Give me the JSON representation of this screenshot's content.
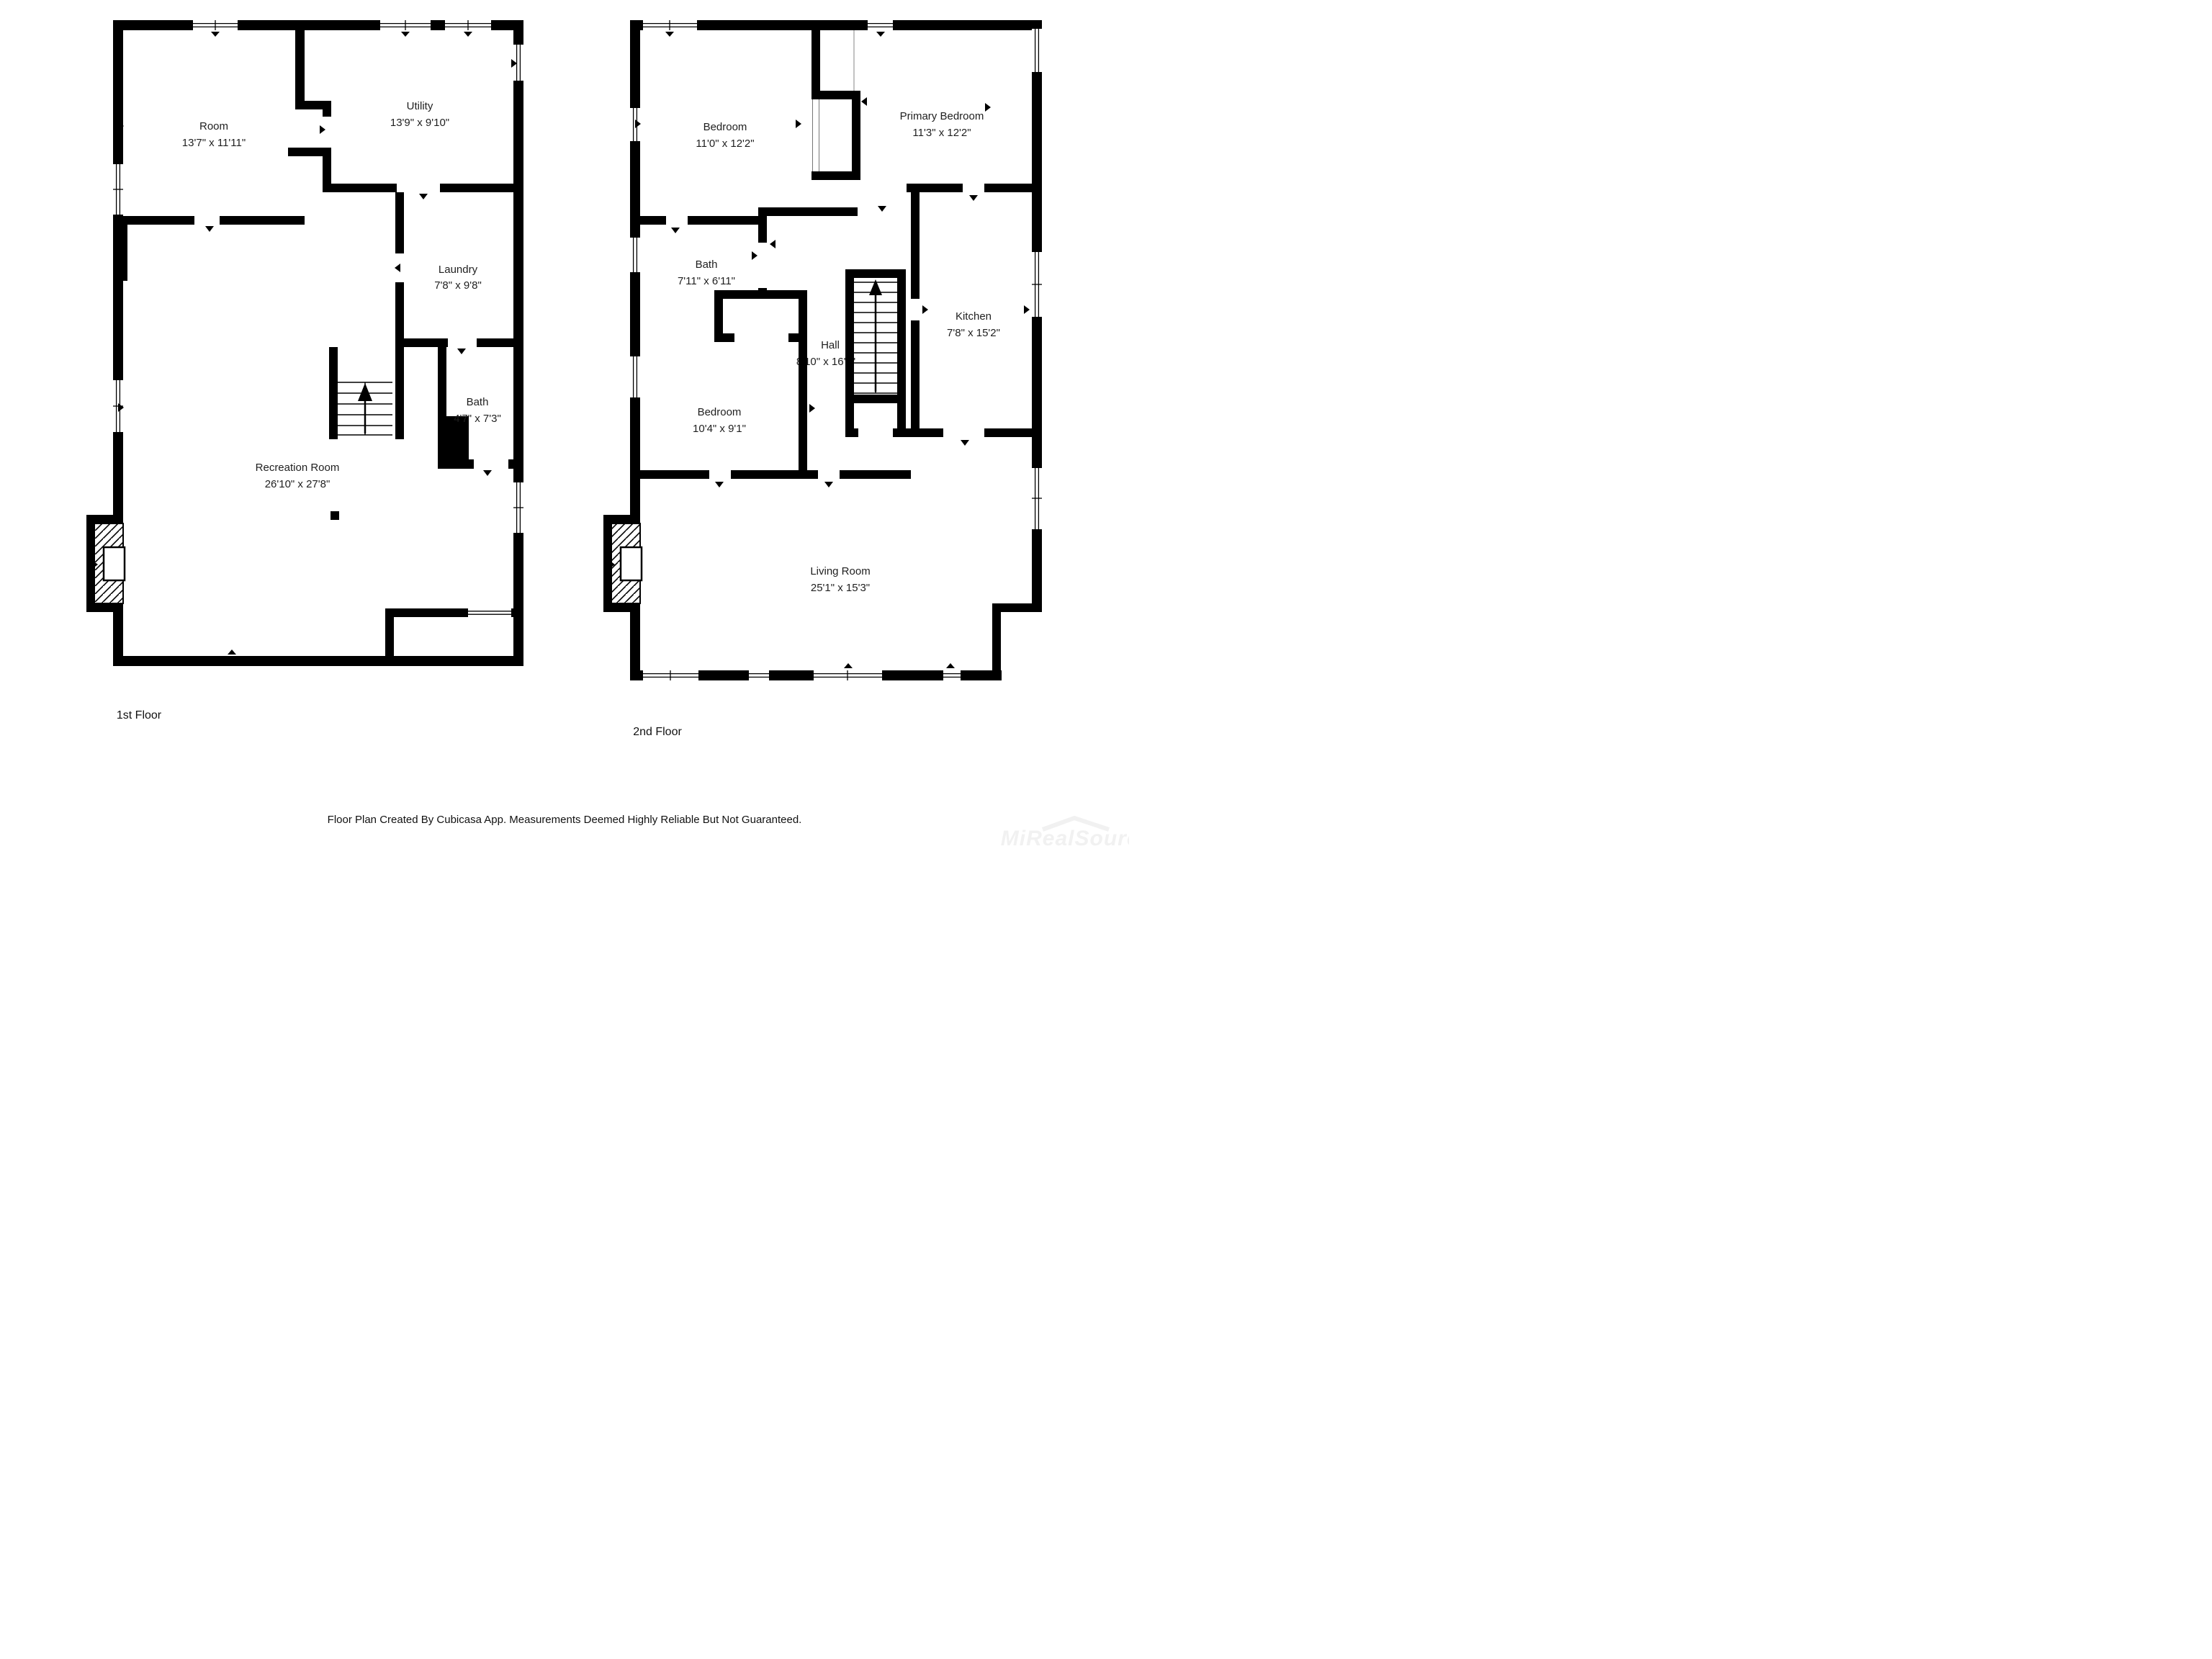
{
  "floors": [
    {
      "label": "1st Floor",
      "rooms": [
        {
          "name": "Room",
          "dims": "13'7\" x 11'11\""
        },
        {
          "name": "Utility",
          "dims": "13'9\" x 9'10\""
        },
        {
          "name": "Laundry",
          "dims": "7'8\" x 9'8\""
        },
        {
          "name": "Bath",
          "dims": "4'7\" x 7'3\""
        },
        {
          "name": "Recreation Room",
          "dims": "26'10\" x 27'8\""
        }
      ]
    },
    {
      "label": "2nd Floor",
      "rooms": [
        {
          "name": "Bedroom",
          "dims": "11'0\" x 12'2\""
        },
        {
          "name": "Primary Bedroom",
          "dims": "11'3\" x 12'2\""
        },
        {
          "name": "Bath",
          "dims": "7'11\" x 6'11\""
        },
        {
          "name": "Hall",
          "dims": "8'10\" x 16'1\""
        },
        {
          "name": "Kitchen",
          "dims": "7'8\" x 15'2\""
        },
        {
          "name": "Bedroom",
          "dims": "10'4\" x 9'1\""
        },
        {
          "name": "Living Room",
          "dims": "25'1\" x 15'3\""
        }
      ]
    }
  ],
  "footer": {
    "disclaimer": "Floor Plan Created By Cubicasa App. Measurements Deemed Highly Reliable But Not Guaranteed."
  },
  "watermark": {
    "text": "MiRealSource"
  },
  "colors": {
    "wall": "#000000",
    "text": "#1f1f1f",
    "background": "#ffffff",
    "watermark": "#f1f1f1"
  }
}
